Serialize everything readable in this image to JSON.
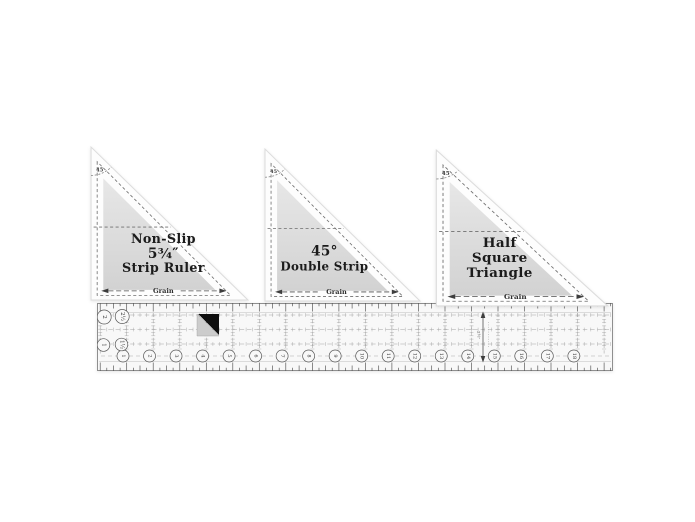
{
  "product": {
    "type": "quilting-ruler-set",
    "triangles": [
      {
        "angle": "45",
        "title_lines": [
          "Non-Slip",
          "5¾″",
          "Strip Ruler"
        ],
        "grain": "Grain"
      },
      {
        "angle": "45",
        "title_lines": [
          "45°",
          "Double Strip"
        ],
        "grain": "Grain"
      },
      {
        "angle": "45",
        "title_lines": [
          "Half",
          "Square",
          "Triangle"
        ],
        "grain": "Grain"
      }
    ],
    "strip_ruler": {
      "bottom_numbers": [
        "1",
        "2",
        "3",
        "4",
        "5",
        "6",
        "7",
        "8",
        "9",
        "10",
        "11",
        "12",
        "13",
        "14",
        "15",
        "16",
        "17",
        "18"
      ],
      "left_numbers": [
        "2",
        "2½",
        "1",
        "1½"
      ],
      "width_label": "2½″"
    },
    "colors": {
      "background": "#ffffff",
      "plastic": "#f8f8f8",
      "gray_top": "#e7e7e7",
      "gray_bottom": "#d2d2d2",
      "marking": "#4f4f4f",
      "grid": "#a3a3a3",
      "marker_black": "#0f0f0f",
      "marker_gray": "#cccccc"
    }
  }
}
